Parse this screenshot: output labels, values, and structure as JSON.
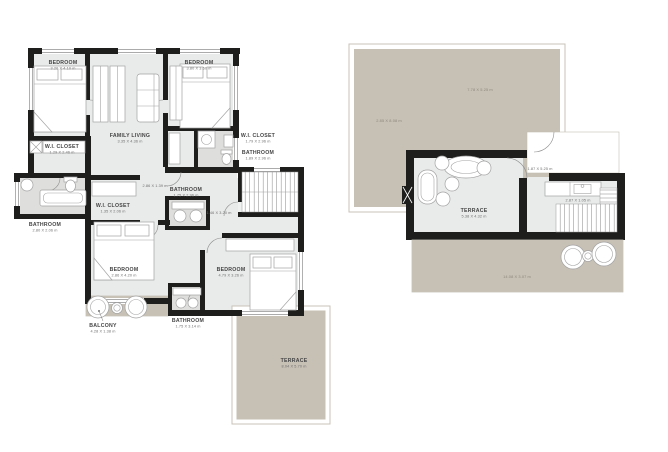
{
  "document": {
    "type": "floor-plan-sheet",
    "background_color": "#ffffff",
    "plans": [
      "first-floor-plan",
      "roof-terrace-plan"
    ]
  },
  "colors": {
    "wall": "#1e1e1c",
    "room_fill": "#e9eaea",
    "bathroom_fill": "#dedfdd",
    "outdoor_fill": "#c7c0b5",
    "stairs_fill": "#eff0f0",
    "furniture_stroke": "#a3a3a3",
    "label_text": "#454545",
    "dimension_text": "#6e6e6e",
    "outdoor_dimension_text": "#8c867c",
    "outdoor_outline": "#c9c3b9"
  },
  "left": {
    "rooms": {
      "bedroom_tl": {
        "name": "BEDROOM",
        "dims": "3.20 X 4.10 m"
      },
      "bedroom_tr": {
        "name": "BEDROOM",
        "dims": "3.80 X 3.60 m"
      },
      "family_living": {
        "name": "FAMILY LIVING",
        "dims": "3.35 X 4.36 m"
      },
      "wi_closet_left": {
        "name": "W.I. CLOSET",
        "dims": "1.29 X 2.46 m"
      },
      "bathroom_left": {
        "name": "BATHROOM",
        "dims": "2.80 X 2.06 m"
      },
      "wi_closet_right": {
        "name": "W.I. CLOSET",
        "dims": "1.79 X 2.96 m"
      },
      "bathroom_right": {
        "name": "BATHROOM",
        "dims": "1.89 X 2.96 m"
      },
      "wi_closet_mid": {
        "name": "W.I. CLOSET",
        "dims": "1.35 X 2.06 m"
      },
      "bathroom_mid": {
        "name": "BATHROOM",
        "dims": "1.75 X 2.96 m"
      },
      "bedroom_ll": {
        "name": "BEDROOM",
        "dims": "2.86 X 4.20 m"
      },
      "bedroom_lr": {
        "name": "BEDROOM",
        "dims": "4.79 X 3.26 m"
      },
      "balcony": {
        "name": "BALCONY",
        "dims": "4.28 X 1.38 m"
      },
      "bathroom_bottom": {
        "name": "BATHROOM",
        "dims": "1.75 X 3.14 m"
      },
      "terrace": {
        "name": "TERRACE",
        "dims": "8.04 X 5.70 m"
      }
    },
    "extra_dims": {
      "hall": "2.86 X 1.39 m",
      "stairs": "1.46 X 3.20 m"
    }
  },
  "right": {
    "rooms": {
      "terrace": {
        "name": "TERRACE",
        "dims": "5.38 X 4.32 m"
      }
    },
    "extra_dims": {
      "roof_upper": "7.78 X 5.25 m",
      "roof_left": "2.85 X 8.08 m",
      "corridor": "1.87 X 5.25 m",
      "kitchen": "2.87 X 1.05 m",
      "roof_lower": "14.08 X 3.07 m"
    }
  }
}
